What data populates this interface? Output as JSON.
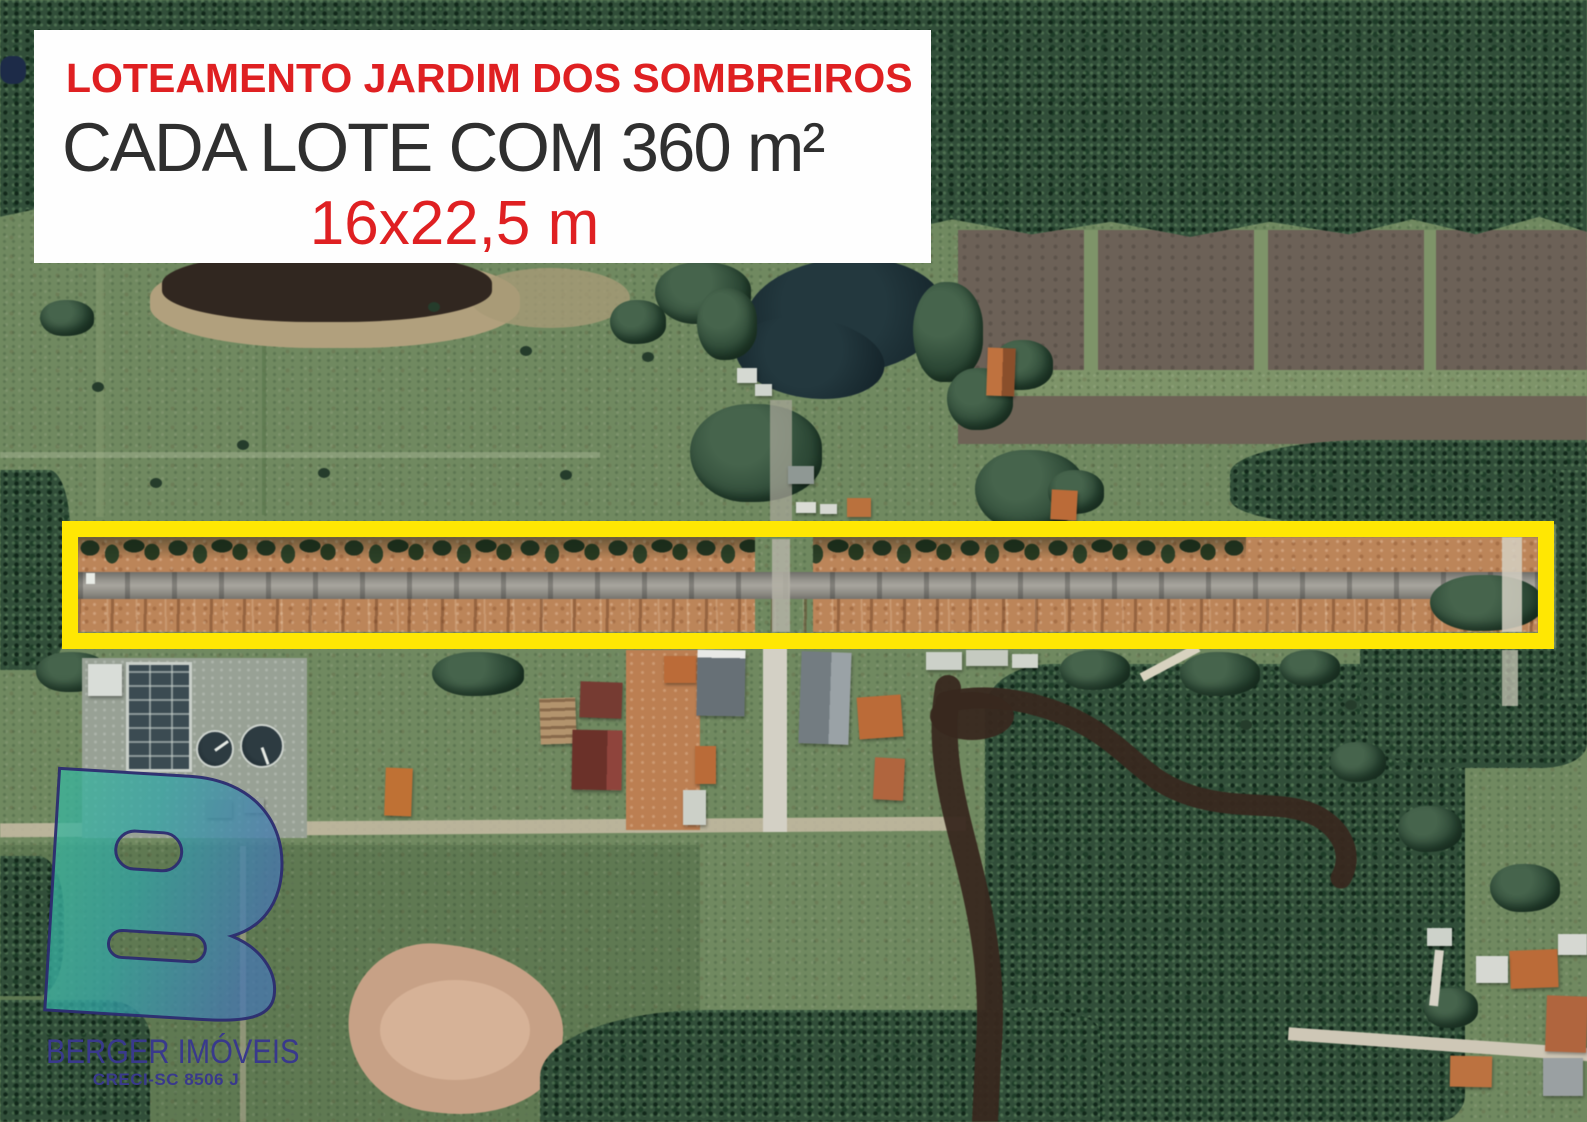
{
  "title_card": {
    "line1": "LOTEAMENTO JARDIM DOS SOMBREIROS",
    "line2": "CADA LOTE COM 360 m²",
    "line3": "16x22,5 m"
  },
  "logo": {
    "company": "BERGER IMÓVEIS",
    "registration": "CRECI-SC 8506 J",
    "monogram": "B"
  },
  "colors": {
    "title_red": "#df2022",
    "title_dark": "#2f2f2f",
    "card_bg": "#fefefe",
    "highlight_yellow": "#ffe703",
    "logo_text": "#39398c",
    "logo_teal": "#3ab79b",
    "logo_blue": "#4677b0",
    "logo_outline": "#2c2c70"
  },
  "map": {
    "type": "satellite-aerial-photo",
    "features": [
      "forest",
      "farm-fields",
      "pond",
      "excavated-pond",
      "highlighted-lot-strip",
      "road",
      "crossing-road",
      "river",
      "houses",
      "water-treatment-plant",
      "dirt-track"
    ]
  }
}
